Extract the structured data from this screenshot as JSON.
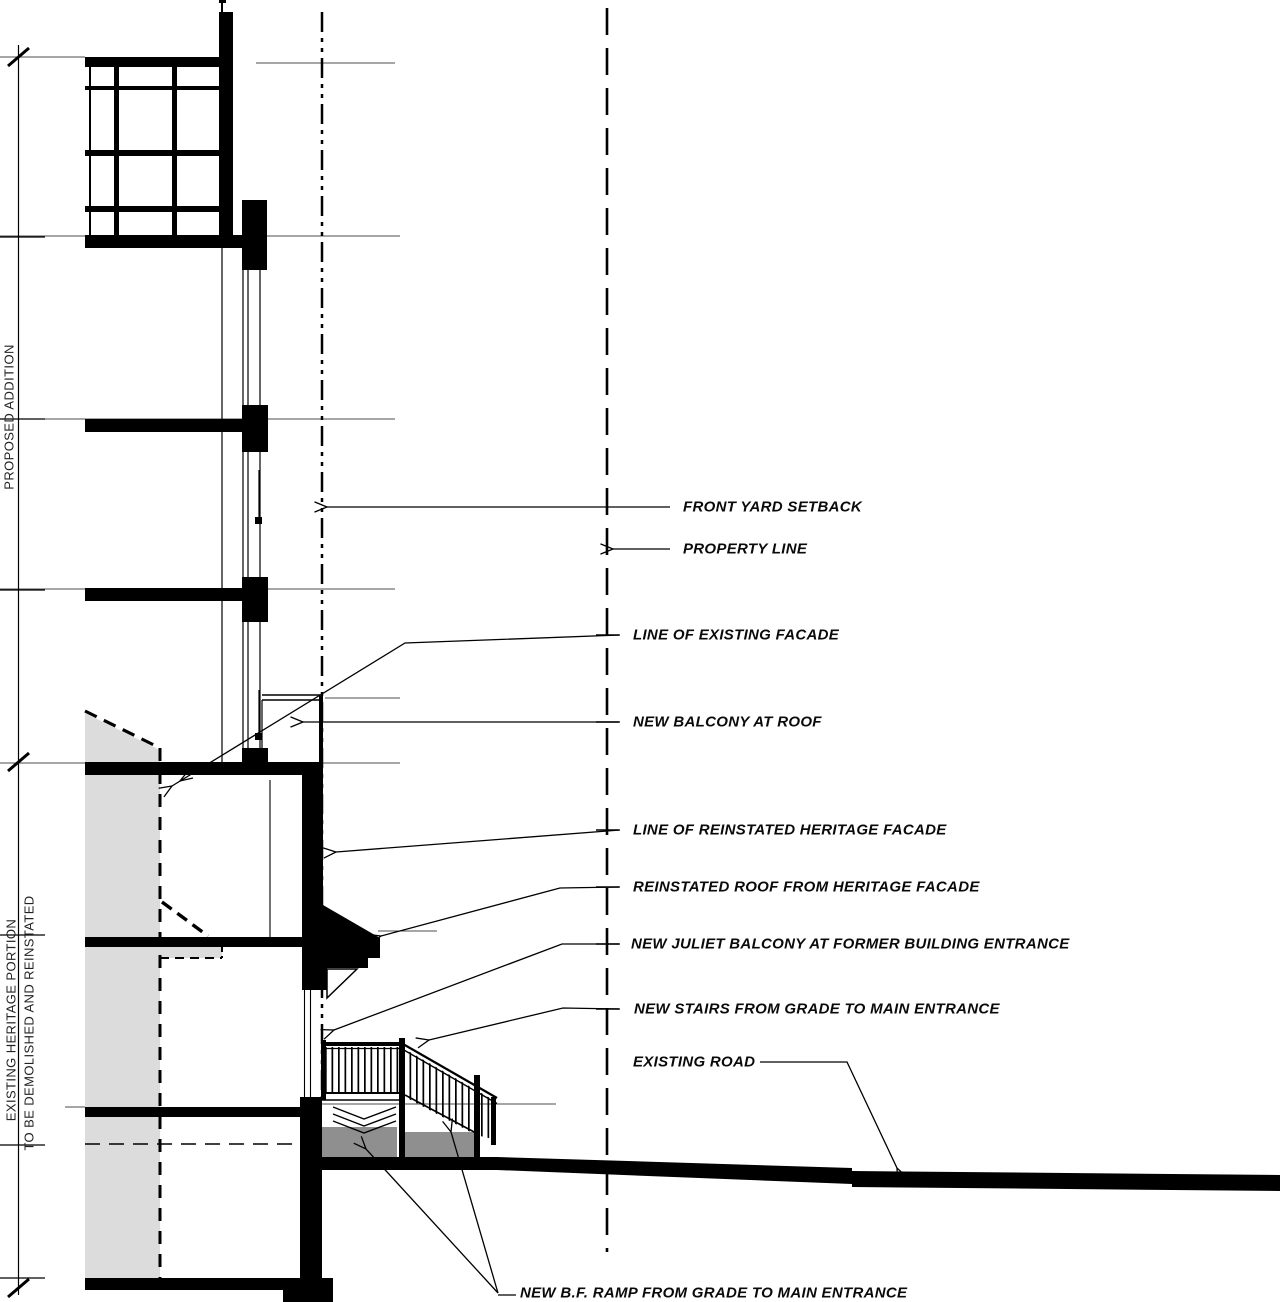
{
  "drawing_side_labels": {
    "proposed_addition": "PROPOSED ADDITION",
    "existing_heritage_line1": "EXISTING HERITAGE PORTION",
    "existing_heritage_line2": "TO BE DEMOLISHED AND REINSTATED"
  },
  "annotations": [
    {
      "label": "FRONT YARD SETBACK"
    },
    {
      "label": "PROPERTY LINE"
    },
    {
      "label": "LINE OF EXISTING FACADE"
    },
    {
      "label": "NEW BALCONY AT ROOF"
    },
    {
      "label": "LINE OF REINSTATED HERITAGE FACADE"
    },
    {
      "label": "REINSTATED ROOF FROM HERITAGE FACADE"
    },
    {
      "label": "NEW JULIET BALCONY AT FORMER BUILDING ENTRANCE"
    },
    {
      "label": "NEW STAIRS FROM GRADE TO MAIN ENTRANCE"
    },
    {
      "label": "EXISTING ROAD"
    },
    {
      "label": "NEW B.F. RAMP FROM GRADE TO MAIN ENTRANCE"
    }
  ],
  "colors": {
    "line": "#000000",
    "thin_line": "#4d4d4d",
    "heritage_fill": "#dcdcdc",
    "ramp_fill": "#8f8f8f",
    "background": "#ffffff"
  }
}
